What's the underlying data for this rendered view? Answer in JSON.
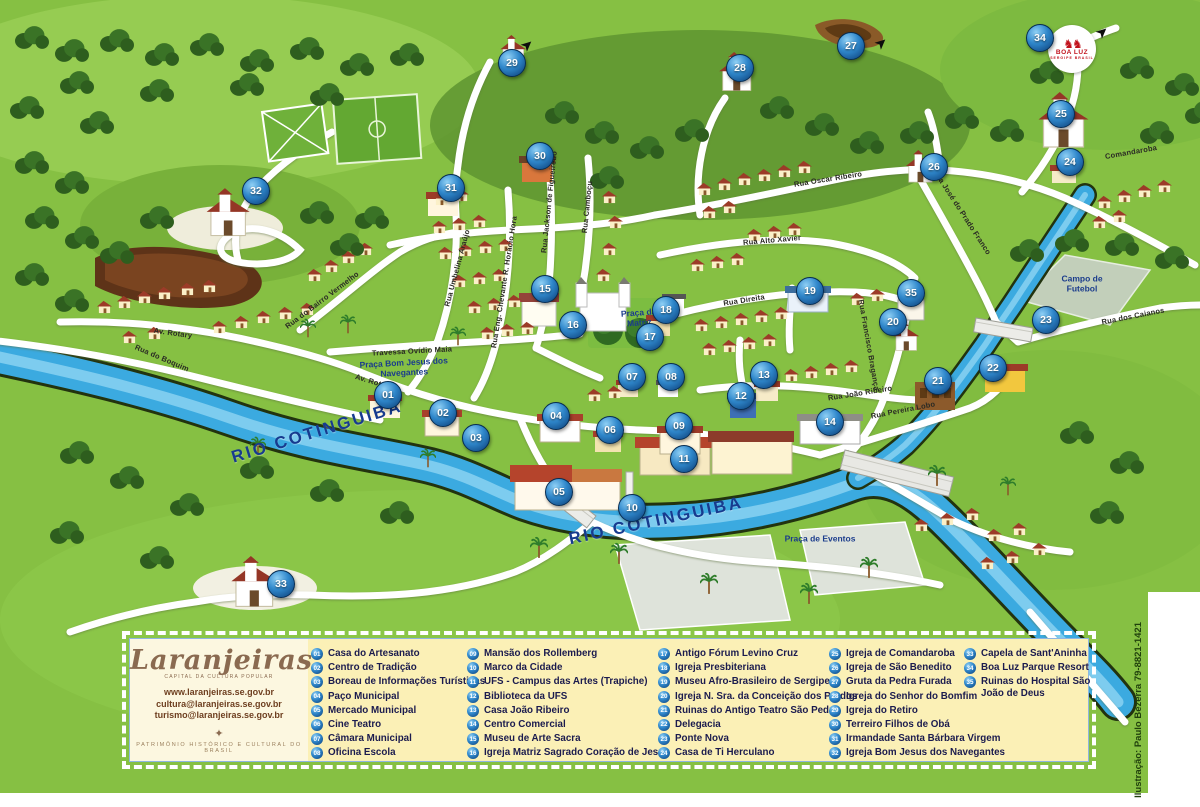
{
  "map": {
    "credit": "Ilustração: Paulo Bezerra 79-8821-1421",
    "boa_luz": {
      "horses": "♞♞",
      "name": "BOA LUZ",
      "sub": "SERGIPE BRASIL"
    },
    "colors": {
      "map_green": "#86C043",
      "river_blue": "#3BAAE0",
      "marker_blue": "#1B5FA8",
      "legend_bg": "#FBF0B6",
      "legend_text": "#1B1B4E",
      "logo_brown": "#8A6A50"
    },
    "areas": [
      {
        "text": "RIO COTINGUIBA",
        "x": 317,
        "y": 432,
        "r": -17,
        "kind": "river"
      },
      {
        "text": "RIO COTINGUIBA",
        "x": 656,
        "y": 521,
        "r": -12,
        "kind": "river"
      },
      {
        "text": "Praça da Matriz",
        "x": 639,
        "y": 318,
        "r": -4,
        "kind": "praca",
        "w": 58
      },
      {
        "text": "Praça Bom Jesus dos Navegantes",
        "x": 404,
        "y": 368,
        "r": -3,
        "kind": "praca",
        "w": 130
      },
      {
        "text": "Praça de Eventos",
        "x": 820,
        "y": 539,
        "r": 0,
        "kind": "praca",
        "w": 140
      },
      {
        "text": "Campo de Futebol",
        "x": 1082,
        "y": 284,
        "r": 0,
        "kind": "praca",
        "w": 66
      }
    ],
    "streets": [
      {
        "text": "Rua do Bairro Vermelho",
        "x": 322,
        "y": 300,
        "r": -37
      },
      {
        "text": "Travessa Ovídio Maia",
        "x": 412,
        "y": 351,
        "r": -3
      },
      {
        "text": "Av. Rotary",
        "x": 374,
        "y": 382,
        "r": 17
      },
      {
        "text": "Av. Rotary",
        "x": 173,
        "y": 333,
        "r": 8
      },
      {
        "text": "Rua do Boquim",
        "x": 162,
        "y": 358,
        "r": 23
      },
      {
        "text": "Rua Oscar Ribeiro",
        "x": 828,
        "y": 179,
        "r": -9
      },
      {
        "text": "Rua Alto Xavier",
        "x": 772,
        "y": 240,
        "r": -5
      },
      {
        "text": "Rua José do Prado Franco",
        "x": 962,
        "y": 212,
        "r": 57
      },
      {
        "text": "Comandaroba",
        "x": 1131,
        "y": 152,
        "r": -10
      },
      {
        "text": "Rua Direita",
        "x": 744,
        "y": 300,
        "r": -9
      },
      {
        "text": "Rua Francisco Bragança",
        "x": 869,
        "y": 345,
        "r": 80
      },
      {
        "text": "Rua João Ribeiro",
        "x": 860,
        "y": 393,
        "r": -9
      },
      {
        "text": "Rua Pereira Lobo",
        "x": 903,
        "y": 410,
        "r": -11
      },
      {
        "text": "Rua dos Caianos",
        "x": 1133,
        "y": 316,
        "r": -11
      },
      {
        "text": "Rua Umbelina Araújo",
        "x": 457,
        "y": 268,
        "r": -75
      },
      {
        "text": "Rua Eng. Chevante R. Horácio Hora",
        "x": 504,
        "y": 282,
        "r": -81
      },
      {
        "text": "Rua Jackson de Figueiredo",
        "x": 549,
        "y": 202,
        "r": -84
      },
      {
        "text": "Rua Camboçu",
        "x": 587,
        "y": 207,
        "r": -84
      }
    ],
    "markers": [
      {
        "n": "01",
        "x": 388,
        "y": 395
      },
      {
        "n": "02",
        "x": 443,
        "y": 413
      },
      {
        "n": "03",
        "x": 476,
        "y": 438
      },
      {
        "n": "04",
        "x": 556,
        "y": 416
      },
      {
        "n": "05",
        "x": 559,
        "y": 492
      },
      {
        "n": "06",
        "x": 610,
        "y": 430
      },
      {
        "n": "07",
        "x": 632,
        "y": 377
      },
      {
        "n": "08",
        "x": 671,
        "y": 377
      },
      {
        "n": "09",
        "x": 679,
        "y": 426
      },
      {
        "n": "10",
        "x": 632,
        "y": 508
      },
      {
        "n": "11",
        "x": 684,
        "y": 459
      },
      {
        "n": "12",
        "x": 741,
        "y": 396
      },
      {
        "n": "13",
        "x": 764,
        "y": 375
      },
      {
        "n": "14",
        "x": 830,
        "y": 422
      },
      {
        "n": "15",
        "x": 545,
        "y": 289
      },
      {
        "n": "16",
        "x": 573,
        "y": 325
      },
      {
        "n": "17",
        "x": 650,
        "y": 337
      },
      {
        "n": "18",
        "x": 666,
        "y": 310
      },
      {
        "n": "19",
        "x": 810,
        "y": 291
      },
      {
        "n": "20",
        "x": 893,
        "y": 322
      },
      {
        "n": "21",
        "x": 938,
        "y": 381
      },
      {
        "n": "22",
        "x": 993,
        "y": 368
      },
      {
        "n": "23",
        "x": 1046,
        "y": 320
      },
      {
        "n": "24",
        "x": 1070,
        "y": 162
      },
      {
        "n": "25",
        "x": 1061,
        "y": 114
      },
      {
        "n": "26",
        "x": 934,
        "y": 167
      },
      {
        "n": "27",
        "x": 851,
        "y": 46
      },
      {
        "n": "28",
        "x": 740,
        "y": 68
      },
      {
        "n": "29",
        "x": 512,
        "y": 63
      },
      {
        "n": "30",
        "x": 540,
        "y": 156
      },
      {
        "n": "31",
        "x": 451,
        "y": 188
      },
      {
        "n": "32",
        "x": 256,
        "y": 191
      },
      {
        "n": "33",
        "x": 281,
        "y": 584
      },
      {
        "n": "34",
        "x": 1040,
        "y": 38
      },
      {
        "n": "35",
        "x": 911,
        "y": 293
      }
    ]
  },
  "legend": {
    "logo_text": "Laranjeiras",
    "logo_tagline": "CAPITAL DA CULTURA POPULAR",
    "website": "www.laranjeiras.se.gov.br",
    "email1": "cultura@laranjeiras.se.gov.br",
    "email2": "turismo@laranjeiras.se.gov.br",
    "compass": "✦",
    "footer": "PATRIMÔNIO HISTÓRICO E CULTURAL DO BRASIL",
    "columns": [
      [
        {
          "num": "01",
          "label": "Casa do Artesanato"
        },
        {
          "num": "02",
          "label": "Centro de Tradição"
        },
        {
          "num": "03",
          "label": "Boreau de Informações Turísticas"
        },
        {
          "num": "04",
          "label": "Paço Municipal"
        },
        {
          "num": "05",
          "label": "Mercado Municipal"
        },
        {
          "num": "06",
          "label": "Cine Teatro"
        },
        {
          "num": "07",
          "label": "Câmara Municipal"
        },
        {
          "num": "08",
          "label": "Oficina Escola"
        }
      ],
      [
        {
          "num": "09",
          "label": "Mansão dos Rollemberg"
        },
        {
          "num": "10",
          "label": "Marco da Cidade"
        },
        {
          "num": "11",
          "label": "UFS - Campus das Artes (Trapiche)"
        },
        {
          "num": "12",
          "label": "Biblioteca da UFS"
        },
        {
          "num": "13",
          "label": "Casa João Ribeiro"
        },
        {
          "num": "14",
          "label": "Centro Comercial"
        },
        {
          "num": "15",
          "label": "Museu de Arte Sacra"
        },
        {
          "num": "16",
          "label": "Igreja Matriz Sagrado Coração de Jesus"
        }
      ],
      [
        {
          "num": "17",
          "label": "Antigo Fórum Levino Cruz"
        },
        {
          "num": "18",
          "label": "Igreja Presbiteriana"
        },
        {
          "num": "19",
          "label": "Museu Afro-Brasileiro de Sergipe"
        },
        {
          "num": "20",
          "label": "Igreja N. Sra. da Conceição dos Pardos"
        },
        {
          "num": "21",
          "label": "Ruinas do Antigo Teatro São Pedro"
        },
        {
          "num": "22",
          "label": "Delegacia"
        },
        {
          "num": "23",
          "label": "Ponte Nova"
        },
        {
          "num": "24",
          "label": "Casa de Ti Herculano"
        }
      ],
      [
        {
          "num": "25",
          "label": "Igreja de Comandaroba"
        },
        {
          "num": "26",
          "label": "Igreja de São Benedito"
        },
        {
          "num": "27",
          "label": "Gruta da Pedra Furada"
        },
        {
          "num": "28",
          "label": "Igreja do Senhor do Bomfim"
        },
        {
          "num": "29",
          "label": "Igreja do Retiro"
        },
        {
          "num": "30",
          "label": "Terreiro Filhos de Obá"
        },
        {
          "num": "31",
          "label": "Irmandade Santa Bárbara Virgem"
        },
        {
          "num": "32",
          "label": "Igreja Bom Jesus dos Navegantes"
        }
      ],
      [
        {
          "num": "33",
          "label": "Capela de Sant'Aninha"
        },
        {
          "num": "34",
          "label": "Boa Luz Parque Resort"
        },
        {
          "num": "35",
          "label": "Ruinas do Hospital São João de Deus"
        }
      ]
    ]
  }
}
